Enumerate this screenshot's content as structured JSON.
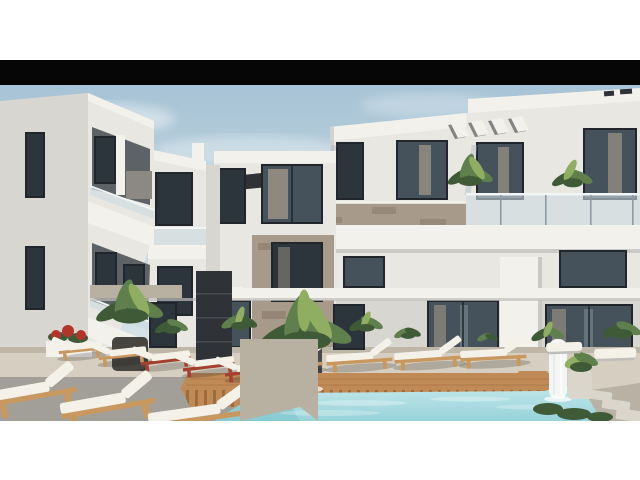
{
  "meta": {
    "type": "architectural-render-photo",
    "description": "Architectural rendering of a modern white apartment complex courtyard with balconies, stone accents, a turquoise swimming pool, wooden deck, white sun loungers and tropical plants under a light blue sky, letterboxed with a black bar above and white margins."
  },
  "letterbox": {
    "color": "#060606"
  },
  "palette": {
    "page_bg": "#ffffff",
    "letterbox": "#060606",
    "sky_top": "#a7c3d5",
    "sky_mid": "#c9dbe3",
    "sky_bottom": "#e4ecee",
    "cloud": "#f2f6f7",
    "wall_lit": "#e9e7e2",
    "wall_warm": "#f3f1ec",
    "wall_mid": "#d8d6d1",
    "wall_shade": "#bfbeba",
    "recess": "#5d6266",
    "window_dark": "#2c353c",
    "window_glass": "#45525b",
    "window_reflect": "#9fb2bb",
    "frame_dark": "#20262b",
    "curtain": "#bfae97",
    "glass_rail": "#ccdbe1",
    "rail_post": "#8d9aa1",
    "stone_light": "#a89a8b",
    "stone_dark": "#857767",
    "slate": "#2f3236",
    "slate_line": "#474b50",
    "wood_deck": "#c08a57",
    "wood_dark": "#9e6b3b",
    "wood_frame": "#c9985f",
    "ground": "#d6cfc1",
    "ground_shade": "#b8b0a1",
    "ground_dark": "#a19f98",
    "pool_light": "#c3e7ea",
    "pool_mid": "#97d3da",
    "pool_deep": "#7cc3cd",
    "cushion": "#f4f1e9",
    "cushion_shade": "#d9d3c5",
    "terracotta": "#a4402e",
    "green": "#5f7f4c",
    "green_dark": "#3f5a37",
    "green_light": "#8fae62",
    "pot_dark": "#46453f",
    "pot_gray": "#8b8982",
    "flower_red": "#b5342a",
    "fountain": "#f4f6f6",
    "paver": "#dad6cc",
    "pebble": "#b9b2a4"
  },
  "scene": {
    "layout": {
      "top_white_margin_px": 60,
      "black_bar_px": 25,
      "photo_top_px": 85,
      "photo_height_px": 336,
      "bottom_white_margin_px": 59
    },
    "elements": [
      "left-apartment-building",
      "mid-left-building",
      "center-stone-building",
      "right-apartment-building",
      "pergola-slats",
      "balcony-glass-railings",
      "slate-accent-wall",
      "terrace-canopy",
      "swimming-pool",
      "pool-deck",
      "waterfall-fountain",
      "drape-fountain",
      "sun-loungers",
      "palm-plants",
      "red-flower-planter",
      "paver-path"
    ],
    "counts": {
      "sun_loungers": 14,
      "fountains": 2,
      "buildings": 4
    }
  }
}
